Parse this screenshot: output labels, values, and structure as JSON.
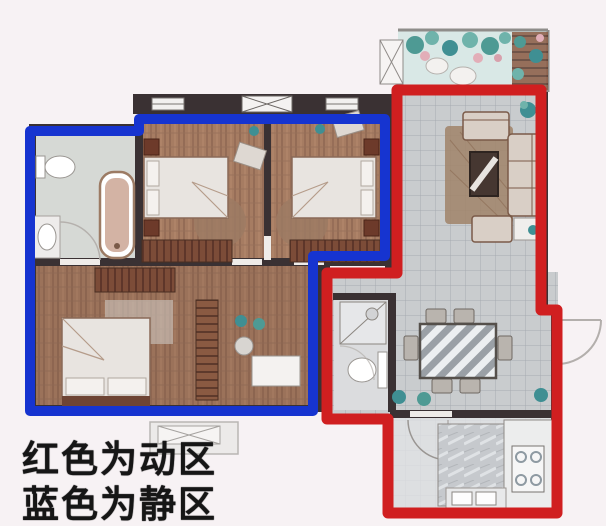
{
  "legend": {
    "line1": "红色为动区",
    "line2": "蓝色为静区"
  },
  "zones": {
    "dynamic": {
      "color": "#d01f20"
    },
    "static": {
      "color": "#1634d0"
    }
  },
  "background_color": "#f7f2f4"
}
